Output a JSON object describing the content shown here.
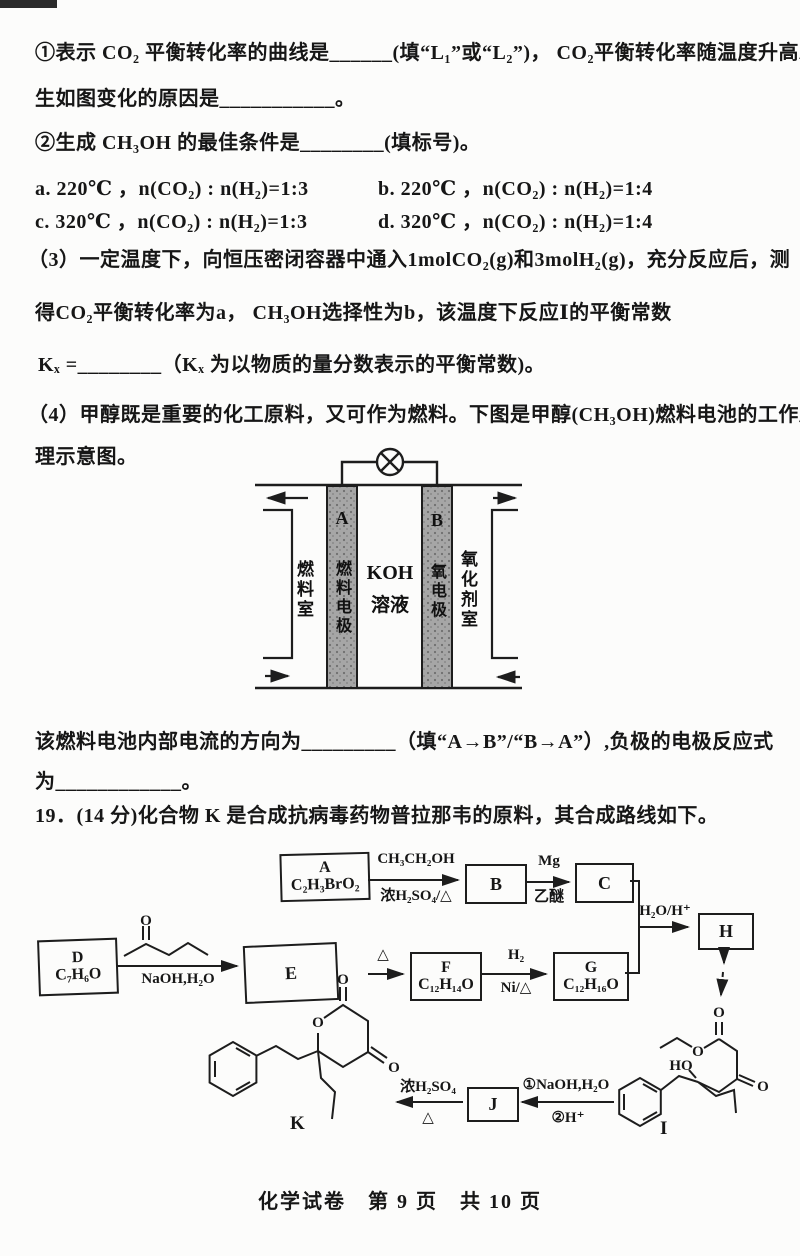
{
  "exam": {
    "line1": "①表示 CO₂ 平衡转化率的曲线是______(填“L₁”或“L₂”)， CO₂平衡转化率随温度升高发",
    "line2": "生如图变化的原因是___________。",
    "line3": "②生成 CH₃OH 的最佳条件是________(填标号)。",
    "opt_a": "a. 220℃ ，n(CO₂) : n(H₂)=1:3",
    "opt_b": "b. 220℃ ，n(CO₂) : n(H₂)=1:4",
    "opt_c": "c. 320℃ ，n(CO₂) : n(H₂)=1:3",
    "opt_d": "d. 320℃ ，n(CO₂) : n(H₂)=1:4",
    "q3_line1": "（3）一定温度下，向恒压密闭容器中通入1molCO₂(g)和3molH₂(g)，充分反应后，测",
    "q3_line2": "得CO₂平衡转化率为a， CH₃OH选择性为b，该温度下反应Ⅰ的平衡常数",
    "q3_line3": "Kₓ =________（Kₓ 为以物质的量分数表示的平衡常数)。",
    "q4_line1": "（4）甲醇既是重要的化工原料，又可作为燃料。下图是甲醇(CH₃OH)燃料电池的工作原",
    "q4_line2": "理示意图。",
    "q4_line3": "该燃料电池内部电流的方向为_________（填“A→B”/“B→A”）,负极的电极反应式",
    "q4_line4": "为____________。",
    "q19_intro": "19．(14 分)化合物 K 是合成抗病毒药物普拉那韦的原料，其合成路线如下。",
    "footer": "化学试卷　第 9 页　共 10 页"
  },
  "fuel_cell": {
    "electrode_a_label": "A",
    "electrode_a_name": "燃料电极",
    "electrode_b_label": "B",
    "electrode_b_name": "氧电极",
    "left_chamber": "燃料室",
    "right_chamber": "氧化剂室",
    "solution_line1": "KOH",
    "solution_line2": "溶液"
  },
  "route": {
    "box_a_letter": "A",
    "box_a_formula": "C₂H₃BrO₂",
    "box_b": "B",
    "box_c": "C",
    "box_h": "H",
    "box_d_letter": "D",
    "box_d_formula": "C₇H₆O",
    "box_e": "E",
    "box_f_letter": "F",
    "box_f_formula": "C₁₂H₁₄O",
    "box_g_letter": "G",
    "box_g_formula": "C₁₂H₁₆O",
    "box_j": "J",
    "arr_ab_top": "CH₃CH₂OH",
    "arr_ab_bottom": "浓H₂SO₄/△",
    "arr_bc_top": "Mg",
    "arr_bc_bottom": "乙醚",
    "arr_cg_label": "H₂O/H⁺",
    "arr_de_bottom": "NaOH,H₂O",
    "arr_ef_top": "△",
    "arr_fg_top": "H₂",
    "arr_fg_bottom": "Ni/△",
    "arr_ij_top": "①NaOH,H₂O",
    "arr_ij_bottom": "②H⁺",
    "arr_jk_top": "浓H₂SO₄",
    "arr_jk_bottom": "△",
    "label_k": "K",
    "label_i": "I",
    "atom_o": "O",
    "atom_ho": "HO"
  }
}
